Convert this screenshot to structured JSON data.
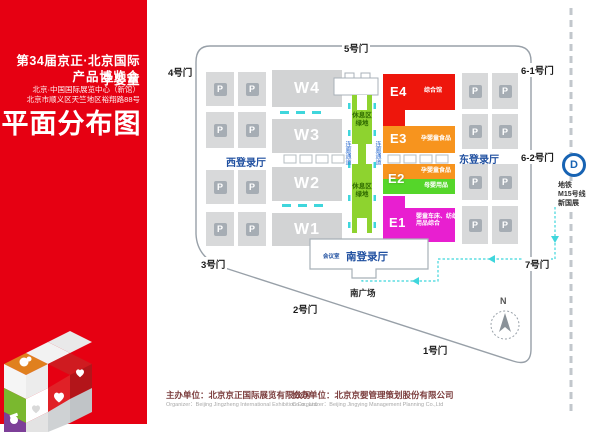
{
  "banner": {
    "title_line1": "第34届京正·北京国际孕婴童",
    "title_line2": "产品博览会",
    "address_line1": "北京·中国国际展览中心（新馆）",
    "address_line2": "北京市顺义区天竺地区裕翔路88号",
    "map_title": "平面分布图",
    "bg_color": "#e60012"
  },
  "map": {
    "gates": {
      "gate5": "5号门",
      "gate4": "4号门",
      "gate3": "3号门",
      "gate2": "2号门",
      "gate1": "1号门",
      "gate61": "6-1号门",
      "gate62": "6-2号门",
      "gate7": "7号门"
    },
    "west_halls": {
      "w4": "W4",
      "w3": "W3",
      "w2": "W2",
      "w1": "W1"
    },
    "east_halls": {
      "e4": {
        "code": "E4",
        "label": "综合馆",
        "color": "#ee160c"
      },
      "e3": {
        "code": "E3",
        "label": "孕婴童食品",
        "color": "#f7941e"
      },
      "e2": {
        "code": "E2",
        "label_top": "孕婴童食品",
        "label_bottom": "母婴用品",
        "color_top": "#f7941e",
        "color_bottom": "#55d62a"
      },
      "e1": {
        "code": "E1",
        "label_line1": "婴童车床、纺织",
        "label_line2": "用品综合",
        "color": "#e81fd0"
      }
    },
    "parking_letter": "P",
    "rest_area_line1": "休息区",
    "rest_area_line2": "绿地",
    "corridor_label": "连廊通道",
    "registration_halls": {
      "west": "西登录厅",
      "east": "东登录厅",
      "south": "南登录厅"
    },
    "meeting_room": "会议室",
    "south_plaza": "南广场",
    "compass_n": "N",
    "subway": {
      "icon_glyph": "D",
      "line1": "地铁",
      "line2": "M15号线",
      "line3": "新国展"
    },
    "colors": {
      "rest_strip_green": "#8ed32f",
      "route_cyan": "#3fd6dc",
      "label_blue": "#1f4fa0",
      "subway_blue": "#1763b3",
      "boundary_gray": "#98a0a8"
    }
  },
  "footer": {
    "organizer_cn": "主办单位：北京京正国际展览有限公司",
    "organizer_en": "Organizer：Beijing Jingzheng International Exhibition Co., Ltd",
    "co_organizer_cn": "协办单位：北京京婴管理策划股份有限公司",
    "co_organizer_en": "Co-organizer：Beijing Jingying Management Planning Co.,Ltd"
  }
}
